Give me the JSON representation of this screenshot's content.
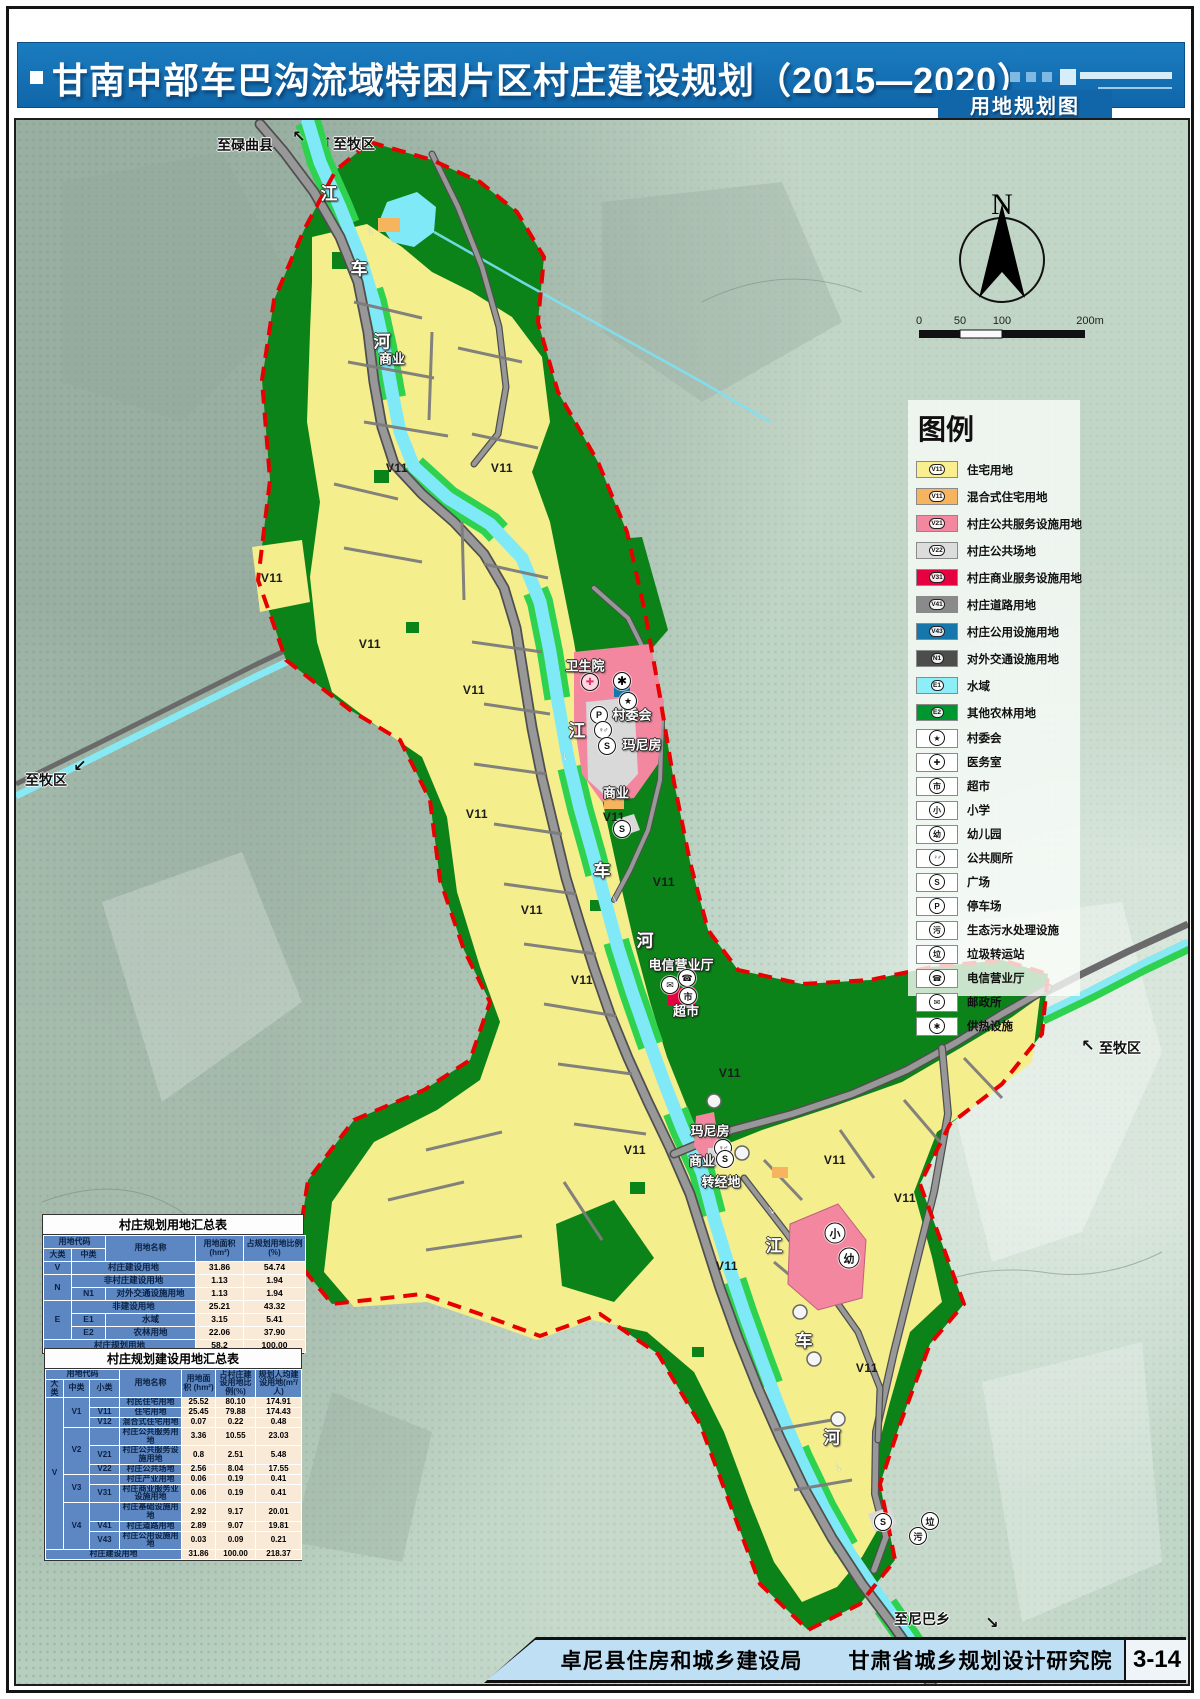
{
  "header": {
    "title": "甘南中部车巴沟流域特困片区村庄建设规划（2015—2020）",
    "subtitle": "用地规划图"
  },
  "footer": {
    "org1": "卓尼县住房和城乡建设局",
    "org2": "甘肃省城乡规划设计研究院",
    "page": "3-14"
  },
  "compass": {
    "label": "N"
  },
  "scalebar": {
    "ticks": [
      "0",
      "50",
      "100",
      "200m"
    ]
  },
  "legend": {
    "title": "图例",
    "color_items": [
      {
        "code": "V11",
        "label": "住宅用地",
        "color": "#f9ef8f"
      },
      {
        "code": "V11",
        "label": "混合式住宅用地",
        "color": "#f7b45f"
      },
      {
        "code": "V21",
        "label": "村庄公共服务设施用地",
        "color": "#f2879f"
      },
      {
        "code": "V22",
        "label": "村庄公共场地",
        "color": "#dcdcdc"
      },
      {
        "code": "V31",
        "label": "村庄商业服务设施用地",
        "color": "#e50040"
      },
      {
        "code": "V41",
        "label": "村庄道路用地",
        "color": "#8a8a8a"
      },
      {
        "code": "V43",
        "label": "村庄公用设施用地",
        "color": "#1677ad"
      },
      {
        "code": "N1",
        "label": "对外交通设施用地",
        "color": "#4d4d4d"
      },
      {
        "code": "E1",
        "label": "水域",
        "color": "#8deef8"
      },
      {
        "code": "E2",
        "label": "其他农林用地",
        "color": "#00962f"
      }
    ],
    "icon_items": [
      {
        "glyph": "★",
        "label": "村委会"
      },
      {
        "glyph": "✚",
        "label": "医务室"
      },
      {
        "glyph": "市",
        "label": "超市"
      },
      {
        "glyph": "小",
        "label": "小学"
      },
      {
        "glyph": "幼",
        "label": "幼儿园"
      },
      {
        "glyph": "♀♂",
        "label": "公共厕所"
      },
      {
        "glyph": "S",
        "label": "广场"
      },
      {
        "glyph": "P",
        "label": "停车场"
      },
      {
        "glyph": "污",
        "label": "生态污水处理设施"
      },
      {
        "glyph": "垃",
        "label": "垃圾转运站"
      },
      {
        "glyph": "☎",
        "label": "电信营业厅"
      },
      {
        "glyph": "✉",
        "label": "邮政所"
      },
      {
        "glyph": "✱",
        "label": "供热设施"
      }
    ]
  },
  "table1": {
    "title": "村庄规划用地汇总表",
    "header_rows": [
      [
        {
          "t": "用地代码",
          "c": 2
        },
        {
          "t": "用地名称",
          "r": 2
        },
        {
          "t": "用地面积 (hm²)",
          "r": 2
        },
        {
          "t": "占规划用地比例(%)",
          "r": 2
        }
      ],
      [
        {
          "t": "大类"
        },
        {
          "t": "中类"
        }
      ]
    ],
    "rows": [
      [
        {
          "t": "V"
        },
        {
          "t": "村庄建设用地",
          "c": 2
        },
        {
          "t": "31.86",
          "k": "n"
        },
        {
          "t": "54.74",
          "k": "n"
        }
      ],
      [
        {
          "t": "N",
          "r": 2
        },
        {
          "t": "非村庄建设用地",
          "c": 2
        },
        {
          "t": "1.13",
          "k": "n"
        },
        {
          "t": "1.94",
          "k": "n"
        }
      ],
      [
        {
          "t": "N1"
        },
        {
          "t": "对外交通设施用地"
        },
        {
          "t": "1.13",
          "k": "n"
        },
        {
          "t": "1.94",
          "k": "n"
        }
      ],
      [
        {
          "t": "E",
          "r": 3
        },
        {
          "t": "非建设用地",
          "c": 2
        },
        {
          "t": "25.21",
          "k": "n"
        },
        {
          "t": "43.32",
          "k": "n"
        }
      ],
      [
        {
          "t": "E1"
        },
        {
          "t": "水域"
        },
        {
          "t": "3.15",
          "k": "n"
        },
        {
          "t": "5.41",
          "k": "n"
        }
      ],
      [
        {
          "t": "E2"
        },
        {
          "t": "农林用地"
        },
        {
          "t": "22.06",
          "k": "n"
        },
        {
          "t": "37.90",
          "k": "n"
        }
      ],
      [
        {
          "t": "村庄规划用地",
          "c": 3
        },
        {
          "t": "58.2",
          "k": "n"
        },
        {
          "t": "100.00",
          "k": "n"
        }
      ]
    ]
  },
  "table2": {
    "title": "村庄规划建设用地汇总表",
    "header_rows": [
      [
        {
          "t": "用地代码",
          "c": 3
        },
        {
          "t": "用地名称",
          "r": 2
        },
        {
          "t": "用地面积 (hm²)",
          "r": 2
        },
        {
          "t": "占村庄建设用地比例(%)",
          "r": 2
        },
        {
          "t": "规划人均建设用地(m²/人)",
          "r": 2
        }
      ],
      [
        {
          "t": "大类"
        },
        {
          "t": "中类"
        },
        {
          "t": "小类"
        }
      ]
    ],
    "rows": [
      [
        {
          "t": "V",
          "r": 11
        },
        {
          "t": "V1",
          "r": 3
        },
        {
          "t": ""
        },
        {
          "t": "村民住宅用地"
        },
        {
          "t": "25.52",
          "k": "n"
        },
        {
          "t": "80.10",
          "k": "n"
        },
        {
          "t": "174.91",
          "k": "n"
        }
      ],
      [
        {
          "t": "V11"
        },
        {
          "t": "住宅用地"
        },
        {
          "t": "25.45",
          "k": "n"
        },
        {
          "t": "79.88",
          "k": "n"
        },
        {
          "t": "174.43",
          "k": "n"
        }
      ],
      [
        {
          "t": "V12"
        },
        {
          "t": "混合式住宅用地"
        },
        {
          "t": "0.07",
          "k": "n"
        },
        {
          "t": "0.22",
          "k": "n"
        },
        {
          "t": "0.48",
          "k": "n"
        }
      ],
      [
        {
          "t": "V2",
          "r": 3
        },
        {
          "t": ""
        },
        {
          "t": "村庄公共服务用地"
        },
        {
          "t": "3.36",
          "k": "n"
        },
        {
          "t": "10.55",
          "k": "n"
        },
        {
          "t": "23.03",
          "k": "n"
        }
      ],
      [
        {
          "t": "V21"
        },
        {
          "t": "村庄公共服务设施用地"
        },
        {
          "t": "0.8",
          "k": "n"
        },
        {
          "t": "2.51",
          "k": "n"
        },
        {
          "t": "5.48",
          "k": "n"
        }
      ],
      [
        {
          "t": "V22"
        },
        {
          "t": "村庄公共场地"
        },
        {
          "t": "2.56",
          "k": "n"
        },
        {
          "t": "8.04",
          "k": "n"
        },
        {
          "t": "17.55",
          "k": "n"
        }
      ],
      [
        {
          "t": "V3",
          "r": 2
        },
        {
          "t": ""
        },
        {
          "t": "村庄产业用地"
        },
        {
          "t": "0.06",
          "k": "n"
        },
        {
          "t": "0.19",
          "k": "n"
        },
        {
          "t": "0.41",
          "k": "n"
        }
      ],
      [
        {
          "t": "V31"
        },
        {
          "t": "村庄商业服务业设施用地"
        },
        {
          "t": "0.06",
          "k": "n"
        },
        {
          "t": "0.19",
          "k": "n"
        },
        {
          "t": "0.41",
          "k": "n"
        }
      ],
      [
        {
          "t": "V4",
          "r": 3
        },
        {
          "t": ""
        },
        {
          "t": "村庄基础设施用地"
        },
        {
          "t": "2.92",
          "k": "n"
        },
        {
          "t": "9.17",
          "k": "n"
        },
        {
          "t": "20.01",
          "k": "n"
        }
      ],
      [
        {
          "t": "V41"
        },
        {
          "t": "村庄道路用地"
        },
        {
          "t": "2.89",
          "k": "n"
        },
        {
          "t": "9.07",
          "k": "n"
        },
        {
          "t": "19.81",
          "k": "n"
        }
      ],
      [
        {
          "t": "V43"
        },
        {
          "t": "村庄公用设施用地"
        },
        {
          "t": "0.03",
          "k": "n"
        },
        {
          "t": "0.09",
          "k": "n"
        },
        {
          "t": "0.21",
          "k": "n"
        }
      ],
      [
        {
          "t": "村庄建设用地",
          "c": 4
        },
        {
          "t": "31.86",
          "k": "n"
        },
        {
          "t": "100.00",
          "k": "n"
        },
        {
          "t": "218.37",
          "k": "n"
        }
      ]
    ]
  },
  "map_labels": [
    {
      "t": "至碌曲县",
      "x": 229,
      "y": 25,
      "c": "dest"
    },
    {
      "t": "至牧区",
      "x": 338,
      "y": 24,
      "c": "dest"
    },
    {
      "t": "至牧区",
      "x": 30,
      "y": 660,
      "c": "dest"
    },
    {
      "t": "至牧区",
      "x": 1104,
      "y": 928,
      "c": "dest"
    },
    {
      "t": "至尼巴乡",
      "x": 906,
      "y": 1499,
      "c": "dest"
    },
    {
      "t": "江",
      "x": 313,
      "y": 72,
      "c": "river"
    },
    {
      "t": "车",
      "x": 343,
      "y": 147,
      "c": "river"
    },
    {
      "t": "河",
      "x": 366,
      "y": 220,
      "c": "river"
    },
    {
      "t": "江",
      "x": 561,
      "y": 609,
      "c": "river"
    },
    {
      "t": "车",
      "x": 586,
      "y": 749,
      "c": "river"
    },
    {
      "t": "河",
      "x": 629,
      "y": 819,
      "c": "river"
    },
    {
      "t": "江",
      "x": 758,
      "y": 1124,
      "c": "river"
    },
    {
      "t": "车",
      "x": 788,
      "y": 1219,
      "c": "river"
    },
    {
      "t": "河",
      "x": 816,
      "y": 1316,
      "c": "river"
    },
    {
      "t": "商业",
      "x": 376,
      "y": 238,
      "c": "fac"
    },
    {
      "t": "卫生院",
      "x": 569,
      "y": 545,
      "c": "fac"
    },
    {
      "t": "村委会",
      "x": 616,
      "y": 594,
      "c": "fac"
    },
    {
      "t": "玛尼房",
      "x": 626,
      "y": 624,
      "c": "fac"
    },
    {
      "t": "商业",
      "x": 600,
      "y": 672,
      "c": "fac"
    },
    {
      "t": "电信营业厅",
      "x": 665,
      "y": 844,
      "c": "fac"
    },
    {
      "t": "超市",
      "x": 670,
      "y": 890,
      "c": "fac"
    },
    {
      "t": "玛尼房",
      "x": 694,
      "y": 1010,
      "c": "fac"
    },
    {
      "t": "商业",
      "x": 686,
      "y": 1040,
      "c": "fac"
    },
    {
      "t": "转经地",
      "x": 705,
      "y": 1061,
      "c": "fac"
    },
    {
      "t": "V11",
      "x": 381,
      "y": 348,
      "c": "v11"
    },
    {
      "t": "V11",
      "x": 486,
      "y": 348,
      "c": "v11"
    },
    {
      "t": "V11",
      "x": 256,
      "y": 458,
      "c": "v11"
    },
    {
      "t": "V11",
      "x": 354,
      "y": 524,
      "c": "v11"
    },
    {
      "t": "V11",
      "x": 458,
      "y": 570,
      "c": "v11"
    },
    {
      "t": "V11",
      "x": 461,
      "y": 694,
      "c": "v11"
    },
    {
      "t": "V11",
      "x": 598,
      "y": 697,
      "c": "v11"
    },
    {
      "t": "V11",
      "x": 516,
      "y": 790,
      "c": "v11"
    },
    {
      "t": "V11",
      "x": 648,
      "y": 762,
      "c": "v11"
    },
    {
      "t": "V11",
      "x": 566,
      "y": 860,
      "c": "v11"
    },
    {
      "t": "V11",
      "x": 714,
      "y": 953,
      "c": "v11"
    },
    {
      "t": "V11",
      "x": 619,
      "y": 1030,
      "c": "v11"
    },
    {
      "t": "V11",
      "x": 819,
      "y": 1040,
      "c": "v11"
    },
    {
      "t": "V11",
      "x": 889,
      "y": 1078,
      "c": "v11"
    },
    {
      "t": "V11",
      "x": 711,
      "y": 1146,
      "c": "v11"
    },
    {
      "t": "V11",
      "x": 851,
      "y": 1248,
      "c": "v11"
    }
  ],
  "map_icons": [
    {
      "g": "✚",
      "x": 574,
      "y": 562,
      "cls": "med"
    },
    {
      "g": "✱",
      "x": 606,
      "y": 561,
      "cls": "heat"
    },
    {
      "g": "★",
      "x": 612,
      "y": 581,
      "cls": ""
    },
    {
      "g": "P",
      "x": 583,
      "y": 595,
      "cls": ""
    },
    {
      "g": "♀♂",
      "x": 587,
      "y": 610,
      "cls": "wc"
    },
    {
      "g": "S",
      "x": 591,
      "y": 626,
      "cls": ""
    },
    {
      "g": "S",
      "x": 606,
      "y": 709,
      "cls": ""
    },
    {
      "g": "✉",
      "x": 654,
      "y": 865,
      "cls": ""
    },
    {
      "g": "☎",
      "x": 671,
      "y": 858,
      "cls": ""
    },
    {
      "g": "市",
      "x": 672,
      "y": 876,
      "cls": ""
    },
    {
      "g": "♀♂",
      "x": 707,
      "y": 1028,
      "cls": "wc"
    },
    {
      "g": "S",
      "x": 709,
      "y": 1039,
      "cls": ""
    },
    {
      "g": "小",
      "x": 819,
      "y": 1113,
      "cls": "big"
    },
    {
      "g": "幼",
      "x": 833,
      "y": 1138,
      "cls": "big"
    },
    {
      "g": "S",
      "x": 867,
      "y": 1402,
      "cls": ""
    },
    {
      "g": "垃",
      "x": 914,
      "y": 1401,
      "cls": ""
    },
    {
      "g": "污",
      "x": 902,
      "y": 1416,
      "cls": ""
    }
  ],
  "map_arrows": [
    {
      "g": "↖",
      "x": 283,
      "y": 17
    },
    {
      "g": "↑",
      "x": 312,
      "y": 22
    },
    {
      "g": "↙",
      "x": 64,
      "y": 646
    },
    {
      "g": "↖",
      "x": 1072,
      "y": 926
    },
    {
      "g": "↘",
      "x": 976,
      "y": 1503
    }
  ],
  "flow_arrows": [
    {
      "x": 356,
      "y": 110,
      "r": 60
    },
    {
      "x": 551,
      "y": 636,
      "r": 80
    },
    {
      "x": 601,
      "y": 779,
      "r": 65
    },
    {
      "x": 757,
      "y": 1089,
      "r": 55
    },
    {
      "x": 824,
      "y": 1346,
      "r": 60
    }
  ]
}
